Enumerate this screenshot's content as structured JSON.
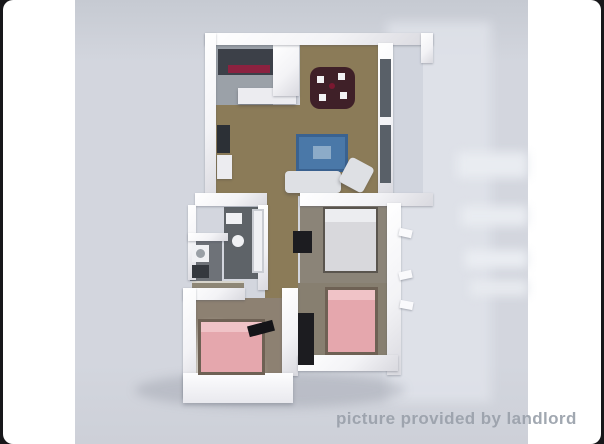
{
  "watermark": {
    "text": "picture provided by landlord"
  },
  "colors": {
    "frame-black": "#17171a",
    "matte-white": "#ffffff",
    "photo-bg-top": "#c6cad2",
    "photo-bg": "#d3d6de",
    "photo-bg-bot": "#cdd0d8",
    "reflection": "#e2e5ec",
    "wall": "#f3f3f6",
    "wall-shade": "#d9d9df",
    "floor-wood": "#8b7b58",
    "floor-kitchen": "#9ba1a8",
    "floor-bath": "#5e6368",
    "floor-laundry": "#6e7278",
    "floor-master": "#8b8478",
    "floor-bedroom-right": "#877f70",
    "floor-bedroom-left": "#8d8172",
    "storage-gray": "#8e8776",
    "counter-dark": "#3c4048",
    "counter-red": "#8c2240",
    "island-white": "#ececf0",
    "table-dark": "#3f2028",
    "chair-white": "#f2f2f4",
    "sofa-blue": "#4a78a8",
    "sofa-blue-dark": "#3a6290",
    "sofa-white": "#dee0e4",
    "tv-dark": "#2c3036",
    "window-dark": "#596068",
    "balcony-glass": "#c6ccd5",
    "bed-white": "#d8d8dc",
    "bed-frame": "#5a554e",
    "pillow-white": "#ecedf0",
    "bed-pink": "#e5a7ad",
    "bed-pink-frame": "#6e6154",
    "pillow-pink": "#f0c3c7",
    "wardrobe-black": "#1c1c20",
    "fixture-white": "#f0f1f4",
    "watermark": "#9aa1ab"
  }
}
